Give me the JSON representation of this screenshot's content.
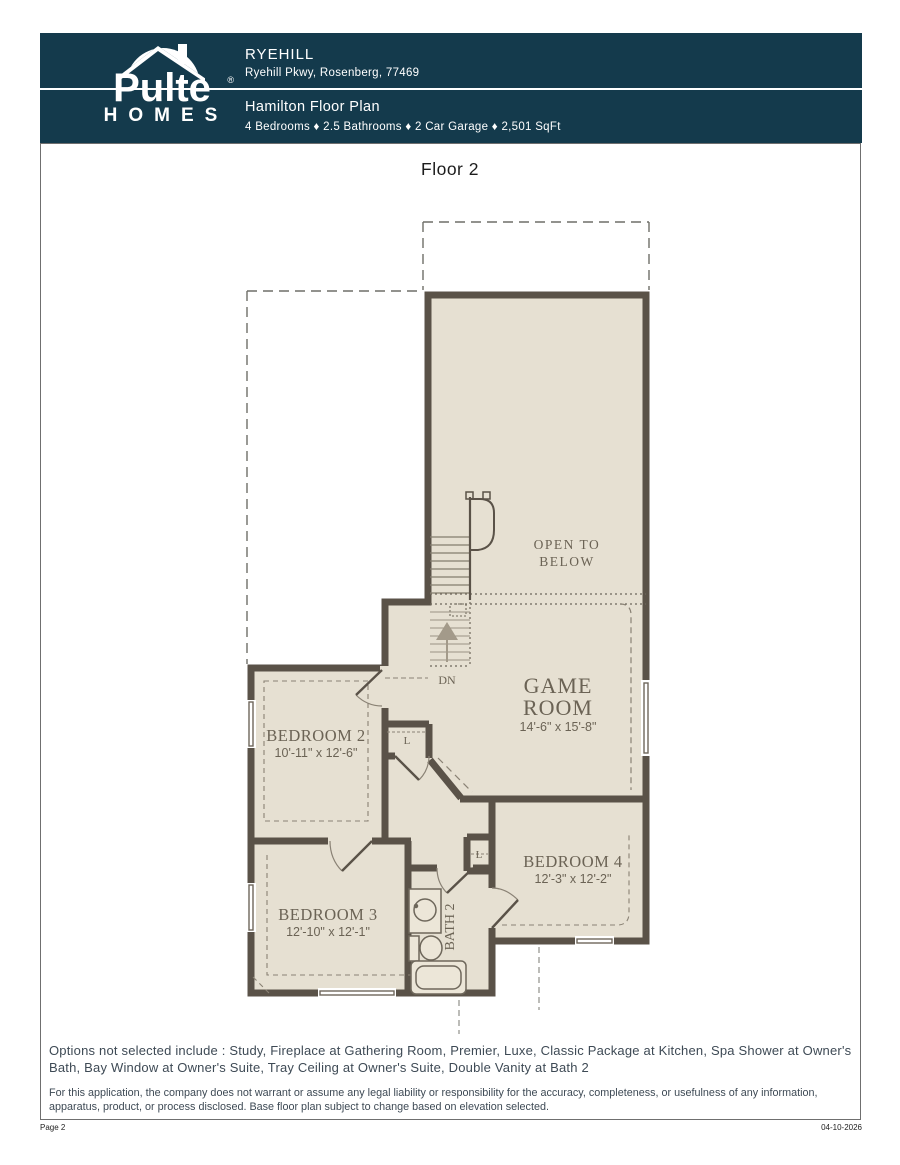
{
  "header": {
    "logo_name": "Pulte",
    "logo_sub": "HOMES",
    "logo_reg": "®",
    "community": "RYEHILL",
    "address": "Ryehill Pkwy, Rosenberg, 77469",
    "plan_name": "Hamilton Floor Plan",
    "specs": "4 Bedrooms ♦ 2.5 Bathrooms ♦ 2 Car Garage ♦ 2,501 SqFt"
  },
  "floor_title": "Floor 2",
  "plan": {
    "labels": {
      "open_to_below_1": "OPEN TO",
      "open_to_below_2": "BELOW",
      "game_room_1": "GAME",
      "game_room_2": "ROOM",
      "game_room_dims": "14'-6\" x 15'-8\"",
      "bedroom2": "BEDROOM 2",
      "bedroom2_dims": "10'-11\" x 12'-6\"",
      "bedroom3": "BEDROOM 3",
      "bedroom3_dims": "12'-10\" x 12'-1\"",
      "bedroom4": "BEDROOM 4",
      "bedroom4_dims": "12'-3\" x 12'-2\"",
      "bath2": "BATH 2",
      "dn": "DN",
      "linen_hall": "L",
      "linen_bed4": "L"
    },
    "colors": {
      "wall": "#5a5248",
      "floor": "#e6e0d2",
      "room_text": "#6b6355",
      "header_bg": "#143a4c"
    }
  },
  "footer": {
    "options": "Options not selected include : Study, Fireplace at Gathering Room, Premier, Luxe, Classic Package at Kitchen, Spa Shower at Owner's Bath, Bay Window at Owner's Suite, Tray Ceiling at Owner's Suite, Double Vanity at Bath 2",
    "disclaimer": "For this application, the company does not warrant or assume any legal liability or responsibility for the accuracy, completeness, or usefulness of any information, apparatus, product, or process disclosed. Base floor plan subject to change based on elevation selected.",
    "page_label": "Page 2",
    "date": "04-10-2026"
  }
}
